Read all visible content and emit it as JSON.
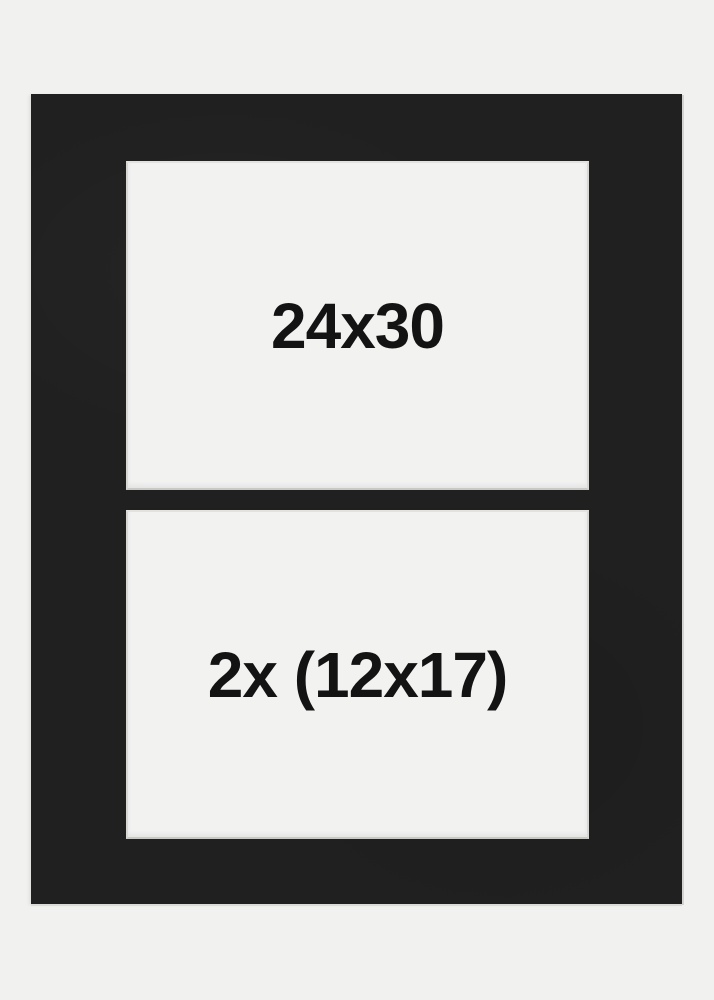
{
  "colors": {
    "background": "#f1f1ef",
    "mat_black": "#202020",
    "opening_white": "#f2f2f1",
    "bevel_edge": "#d8d7d3",
    "label_text": "#131313"
  },
  "mat": {
    "openings": [
      {
        "label": "24x30"
      },
      {
        "label": "2x (12x17)"
      }
    ]
  }
}
